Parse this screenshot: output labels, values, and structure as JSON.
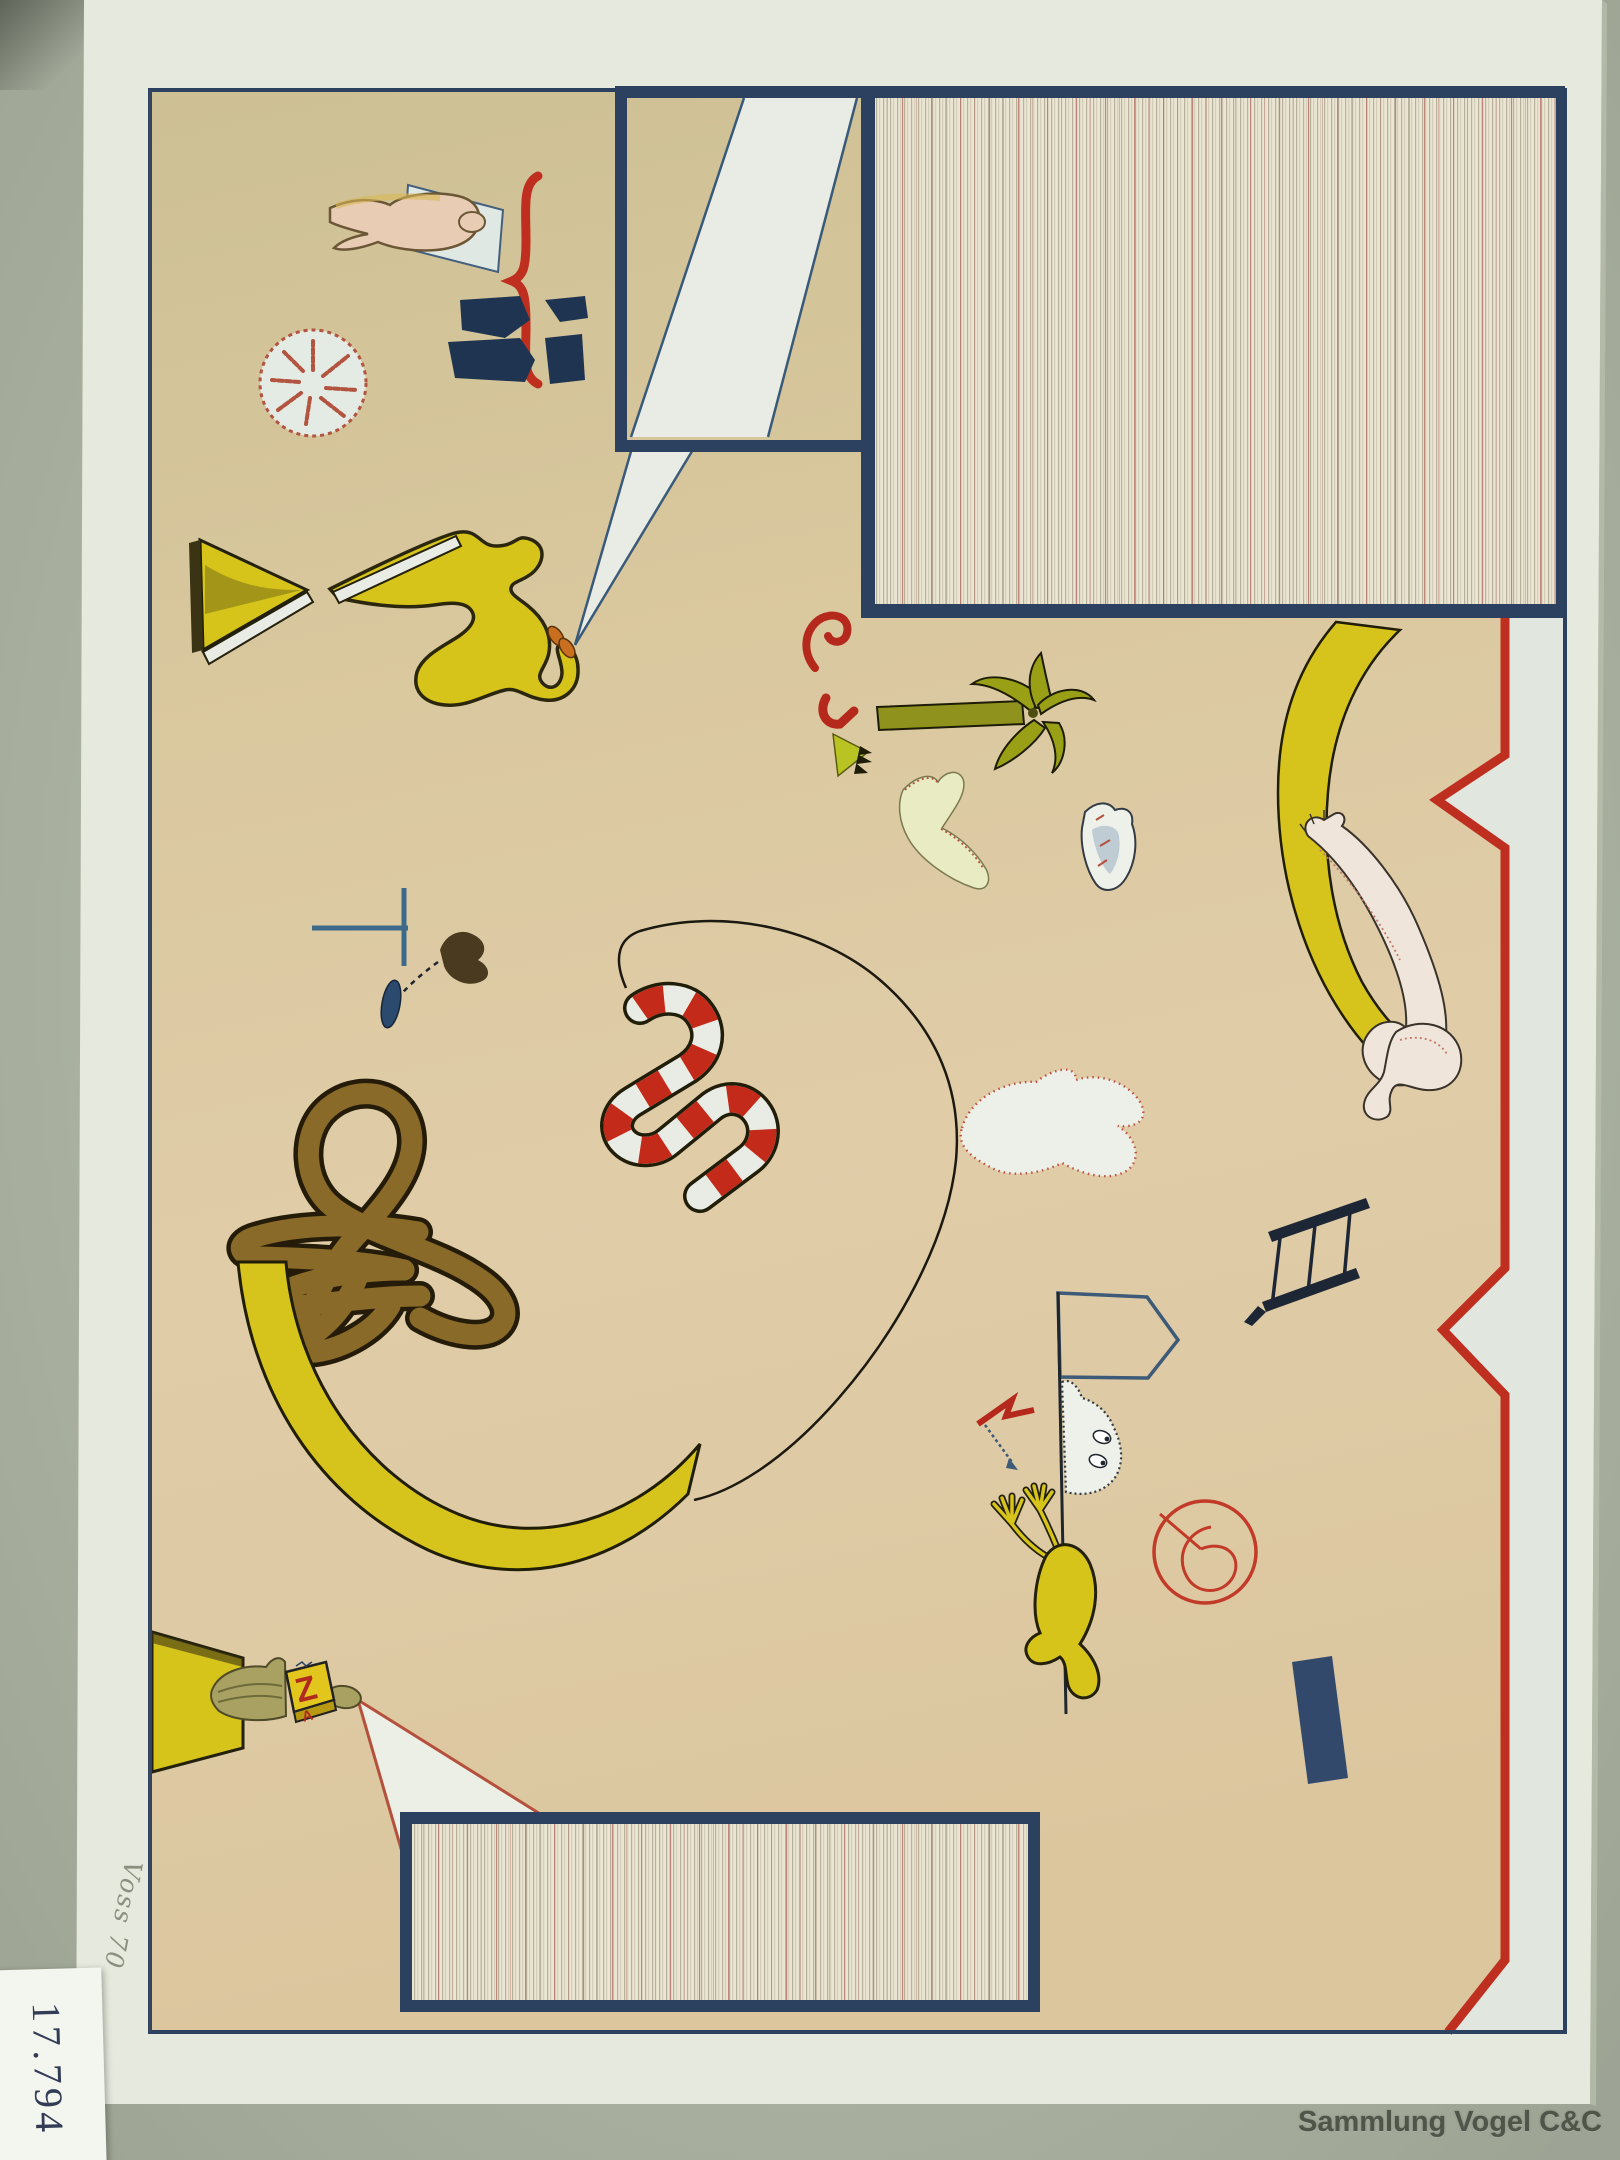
{
  "photo": {
    "watermark": "Sammlung Vogel C&C",
    "sticker_label": "17.794",
    "pencil_note": "Voss 70"
  },
  "artwork": {
    "cube_letters": {
      "front": "Z",
      "side": "A"
    },
    "colors": {
      "mat": "#bcc4b1",
      "mat_shadow": "#79816f",
      "paper": "#e6e9dd",
      "field": "#dcc8a0",
      "field_top": "#cfc296",
      "navy": "#2c4160",
      "panel_line": "#35517b",
      "stripe_bg": "#eae6d3",
      "stripe_line": "#b7b09a",
      "stripe_red": "#b5776b",
      "stone_dark": "#22314a",
      "stone_mid": "#8094ab",
      "stone_light": "#eff1e9",
      "red": "#bf2f1f",
      "red_soft": "#b5503c",
      "yellow": "#d7c41a",
      "olive": "#8f921c",
      "statue_olive": "#a9a162",
      "brown": "#8a6a28",
      "brown_outline": "#241c08",
      "flesh": "#e8cdb4",
      "flesh_pale": "#f0e5da",
      "white_area": "#e9ece4",
      "pale_margin": "#e1e6df",
      "green_figure": "#e9ebc2",
      "ghost": "#eef1ea",
      "blue_accent": "#3d6a8a",
      "navy_bar": "#33496b",
      "ink": "#20262e",
      "sticker": "#f3f5ef",
      "label_ink": "#323c55",
      "pencil": "#7b8170",
      "watermark": "#50554a"
    },
    "top_panel": {
      "red_dot": {
        "x": 1016,
        "y": 530,
        "r": 13
      },
      "stones": [
        {
          "x": 705,
          "y": 178,
          "s": 1.15,
          "r": -10,
          "v": "A"
        },
        {
          "x": 812,
          "y": 150,
          "s": 0.8,
          "r": 15,
          "v": "B"
        },
        {
          "x": 908,
          "y": 152,
          "s": 0.95,
          "r": 170,
          "v": "C"
        },
        {
          "x": 1008,
          "y": 140,
          "s": 1.0,
          "r": -8,
          "v": "A"
        },
        {
          "x": 1098,
          "y": 116,
          "s": 0.8,
          "r": 20,
          "v": "B"
        },
        {
          "x": 1205,
          "y": 128,
          "s": 0.95,
          "r": 95,
          "v": "C"
        },
        {
          "x": 1308,
          "y": 112,
          "s": 0.85,
          "r": -25,
          "v": "B"
        },
        {
          "x": 1432,
          "y": 124,
          "s": 1.05,
          "r": 165,
          "v": "A"
        },
        {
          "x": 1262,
          "y": 192,
          "s": 0.8,
          "r": -45,
          "v": "B"
        },
        {
          "x": 1382,
          "y": 204,
          "s": 0.9,
          "r": 35,
          "v": "C"
        },
        {
          "x": 1490,
          "y": 258,
          "s": 0.85,
          "r": 60,
          "v": "B"
        },
        {
          "x": 968,
          "y": 232,
          "s": 1.1,
          "r": 5,
          "v": "A"
        },
        {
          "x": 995,
          "y": 322,
          "s": 1.0,
          "r": 195,
          "v": "C"
        },
        {
          "x": 937,
          "y": 382,
          "s": 0.95,
          "r": 25,
          "v": "B"
        },
        {
          "x": 1138,
          "y": 362,
          "s": 0.85,
          "r": -15,
          "v": "C"
        },
        {
          "x": 1292,
          "y": 332,
          "s": 0.8,
          "r": 140,
          "v": "B"
        },
        {
          "x": 1452,
          "y": 332,
          "s": 0.95,
          "r": -35,
          "v": "A"
        },
        {
          "x": 1032,
          "y": 482,
          "s": 1.05,
          "r": 8,
          "v": "A"
        },
        {
          "x": 1232,
          "y": 532,
          "s": 0.95,
          "r": -115,
          "v": "C"
        },
        {
          "x": 1364,
          "y": 462,
          "s": 0.8,
          "r": 28,
          "v": "B"
        },
        {
          "x": 1518,
          "y": 486,
          "s": 0.85,
          "r": 75,
          "v": "C"
        },
        {
          "x": 922,
          "y": 538,
          "s": 0.8,
          "r": 165,
          "v": "B"
        }
      ]
    },
    "bottom_panel": {
      "stones": [
        {
          "x": 505,
          "y": 1882,
          "s": 1.05,
          "r": 85,
          "v": "A"
        },
        {
          "x": 588,
          "y": 1952,
          "s": 0.85,
          "r": -25,
          "v": "B"
        },
        {
          "x": 662,
          "y": 1870,
          "s": 0.95,
          "r": 150,
          "v": "C"
        },
        {
          "x": 748,
          "y": 1948,
          "s": 0.9,
          "r": 45,
          "v": "B"
        },
        {
          "x": 822,
          "y": 1874,
          "s": 1.0,
          "r": -95,
          "v": "C"
        },
        {
          "x": 902,
          "y": 1952,
          "s": 0.95,
          "r": 12,
          "v": "A"
        },
        {
          "x": 970,
          "y": 1882,
          "s": 0.85,
          "r": -150,
          "v": "B"
        },
        {
          "x": 532,
          "y": 1978,
          "s": 0.7,
          "r": 120,
          "v": "C"
        },
        {
          "x": 1002,
          "y": 1962,
          "s": 0.7,
          "r": 65,
          "v": "C"
        }
      ]
    },
    "red_dots": [
      {
        "x": 1158,
        "y": 782,
        "r": 5
      },
      {
        "x": 720,
        "y": 258,
        "r": 4
      },
      {
        "x": 731,
        "y": 294,
        "r": 5
      }
    ],
    "scribbles": [
      {
        "x": 810,
        "y": 118,
        "rot": -30
      },
      {
        "x": 818,
        "y": 165,
        "rot": 80
      },
      {
        "x": 845,
        "y": 150,
        "rot": 40
      },
      {
        "x": 838,
        "y": 108,
        "rot": 0,
        "c": "navy"
      },
      {
        "x": 255,
        "y": 428,
        "rot": 10
      },
      {
        "x": 376,
        "y": 838,
        "rot": -20
      },
      {
        "x": 259,
        "y": 858,
        "rot": 15
      },
      {
        "x": 415,
        "y": 920,
        "rot": 0
      },
      {
        "x": 1220,
        "y": 1262,
        "rot": -20
      },
      {
        "x": 1472,
        "y": 650,
        "rot": 60
      },
      {
        "x": 700,
        "y": 1608,
        "rot": 25
      },
      {
        "x": 802,
        "y": 1582,
        "rot": -10
      },
      {
        "x": 902,
        "y": 1642,
        "rot": 35
      },
      {
        "x": 645,
        "y": 1756,
        "rot": 15
      },
      {
        "x": 1448,
        "y": 1872,
        "rot": -35
      },
      {
        "x": 1210,
        "y": 1140,
        "rot": 10
      },
      {
        "x": 566,
        "y": 1586,
        "rot": 0
      },
      {
        "x": 748,
        "y": 1700,
        "rot": -25
      }
    ]
  }
}
